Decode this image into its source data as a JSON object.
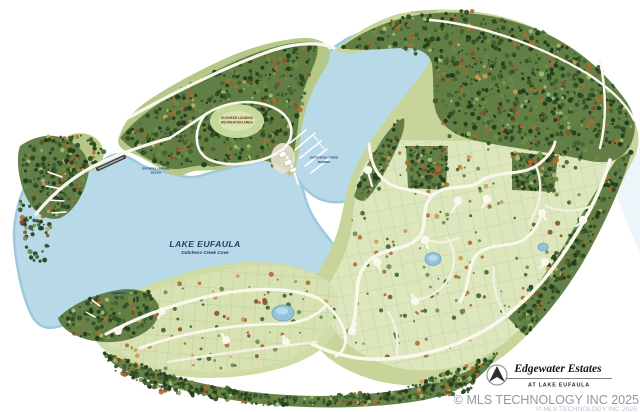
{
  "map": {
    "labels": {
      "lake_name": "LAKE EUFAULA",
      "lake_cove": "Dutchess Creek Cove",
      "marina_1": "DUTCHESS CREEK",
      "marina_2": "MARINA",
      "recreation_1": "DUCHESS LANDING",
      "recreation_2": "RECREATION AREA",
      "beach_1": "DUCHESS LANDING",
      "beach_2": "BEACH",
      "swim_1": "SWIMMING",
      "swim_2": "BEACH",
      "road_top": "DUCHESS ROAD"
    },
    "title_block": {
      "title": "Edgewater Estates",
      "subtitle": "AT LAKE EUFAULA"
    },
    "watermark": {
      "text": "© MLS TECHNOLOGY INC 2025",
      "echo": "© MLS TECHNOLOGY INC 2025"
    },
    "colors": {
      "water": "#b7d9e8",
      "water_edge": "#9ec9dd",
      "water_pale": "#e2eff6",
      "lots": "#dde7bd",
      "lots_lower": "#d7e2b2",
      "land": "#b6c887",
      "forest_under": "#5d7a40",
      "road": "#faf7ec",
      "lake_label": "#24406e",
      "watermark": "#8e9296",
      "watermark_echo": "#a9b6c9"
    }
  }
}
